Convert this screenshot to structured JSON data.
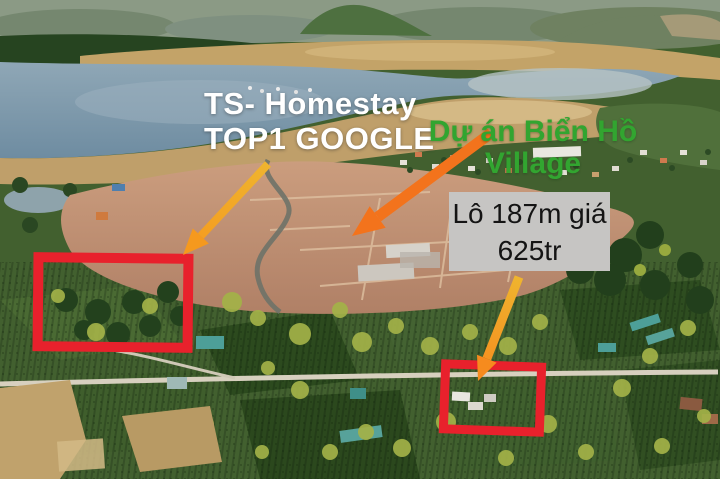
{
  "scene": {
    "description": "Aerial drone photo of a lakeside land-sale advertisement with annotation overlays",
    "photo_features": [
      "mountains",
      "lake",
      "dry sand flats",
      "village shoreline",
      "cleared red-dirt project land",
      "green farmland and orchards",
      "rural roads",
      "scattered houses"
    ]
  },
  "overlays": {
    "headline": {
      "line1": "TS- Homestay",
      "line2": "TOP1 GOOGLE",
      "color": "#ffffff"
    },
    "project": {
      "line1": "Dự án Biển Hồ",
      "line2": "Village",
      "color": "#32a530"
    },
    "price_label": {
      "line1": "Lô 187m giá",
      "line2": "625tr",
      "bg": "#c6c5c3",
      "text_color": "#141414"
    }
  },
  "annotations": {
    "highlight_color": "#e8212c",
    "arrow_gold": "#efb42e",
    "arrow_orange": "#f3731c",
    "rect_left": "red outline around homestay land parcel",
    "rect_right": "red outline around 187m lot with farm buildings",
    "arrow_headline_target": "from TOP1 GOOGLE text down-left to left red rectangle",
    "arrow_project_target": "from Dự án Biển Hồ text down-left to cleared project land",
    "arrow_price_target": "from price label down to right red rectangle"
  }
}
